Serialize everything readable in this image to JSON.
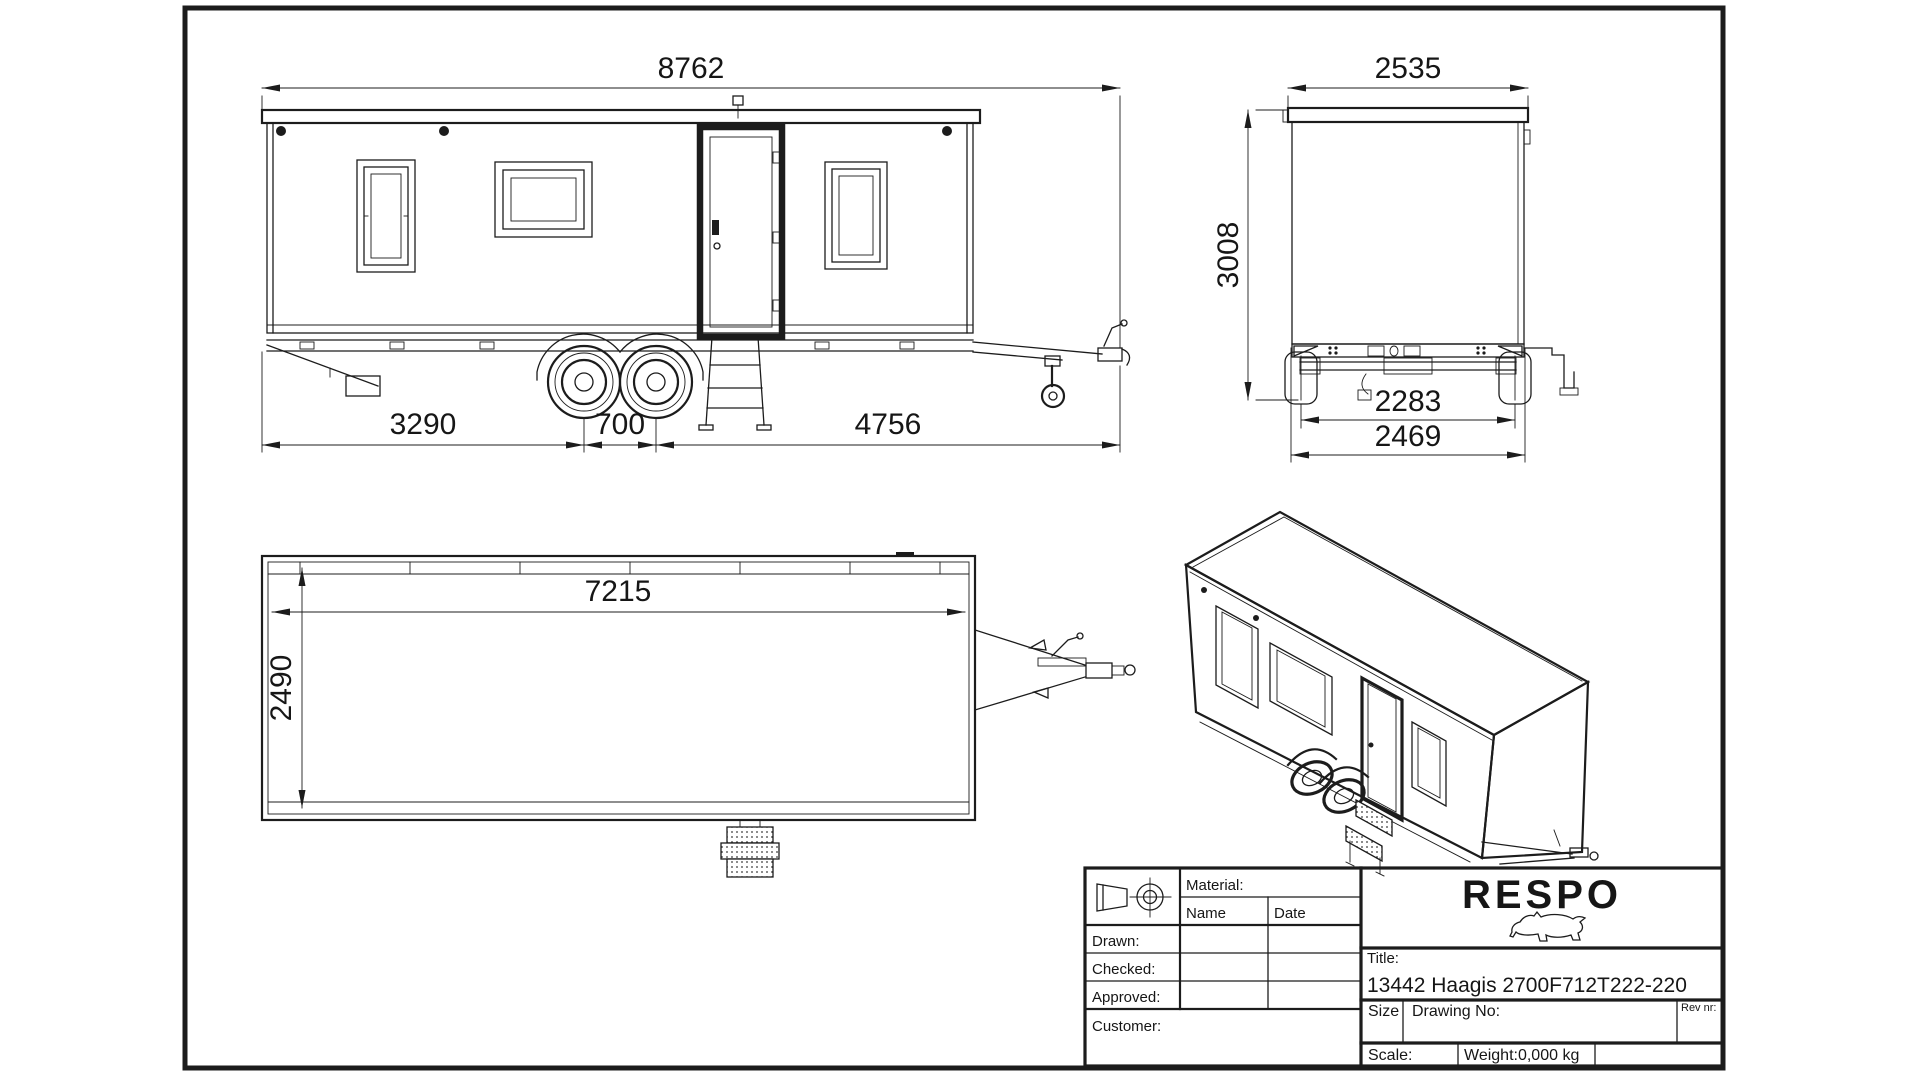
{
  "sheet": {
    "background_color": "#ffffff",
    "line_color": "#1c1c1c"
  },
  "views": {
    "side": {
      "overall_length": "8762",
      "rear_to_axle": "3290",
      "axle_spacing": "700",
      "axle_to_coupling": "4756"
    },
    "rear": {
      "overall_width": "2535",
      "overall_height": "3008",
      "track_width": "2283",
      "body_width": "2469"
    },
    "plan": {
      "internal_length": "7215",
      "internal_width": "2490"
    }
  },
  "title_block": {
    "material_label": "Material:",
    "name_label": "Name",
    "date_label": "Date",
    "drawn_label": "Drawn:",
    "checked_label": "Checked:",
    "approved_label": "Approved:",
    "customer_label": "Customer:",
    "brand": "RESPO",
    "brand_color": "#e2582a",
    "bull_icon": "respo-bull-logo",
    "projection_icon": "first-angle-projection-symbol",
    "title_label": "Title:",
    "title_value": "13442 Haagis 2700F712T222-220",
    "size_label": "Size",
    "drawing_no_label": "Drawing No:",
    "rev_label": "Rev nr:",
    "scale_label": "Scale:",
    "weight_value": "Weight:0,000 kg"
  }
}
